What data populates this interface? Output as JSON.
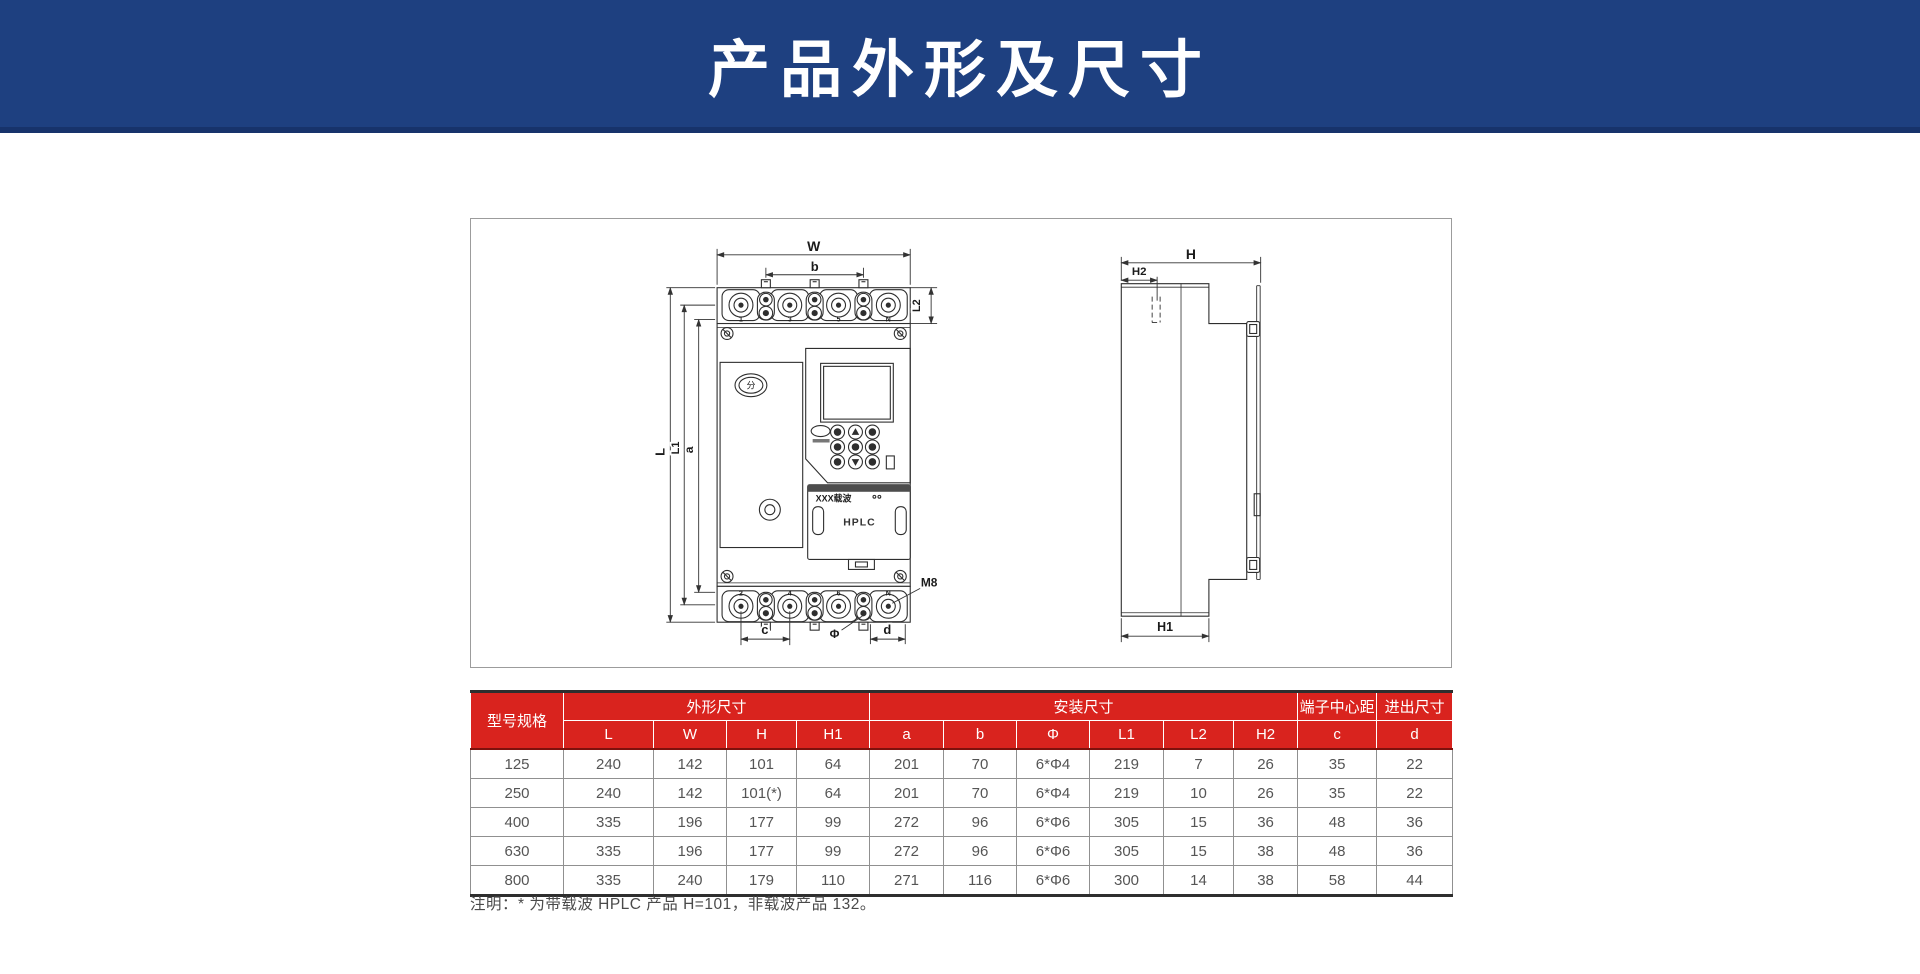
{
  "header": {
    "title": "产品外形及尺寸"
  },
  "colors": {
    "header_bg": "#1E4080",
    "header_strip": "#17336B",
    "table_red": "#D9231E"
  },
  "drawing": {
    "front": {
      "dim_W": "W",
      "dim_b": "b",
      "dim_L": "L",
      "dim_L1": "L1",
      "dim_a": "a",
      "dim_L2": "L2",
      "dim_c": "c",
      "dim_phi": "Φ",
      "dim_d": "d",
      "bolt_label": "M8",
      "top_terminal_labels": [
        "1",
        "3",
        "5",
        "N"
      ],
      "bottom_terminal_labels": [
        "2",
        "4",
        "6",
        "N"
      ],
      "logo_glyph": "分",
      "module_title": "XXX载波",
      "module_name": "HPLC"
    },
    "side": {
      "dim_H": "H",
      "dim_H2": "H2",
      "dim_H1": "H1"
    }
  },
  "table": {
    "header": {
      "model": "型号规格",
      "outline_group": "外形尺寸",
      "install_group": "安装尺寸",
      "terminal_pitch": "端子中心距",
      "inout": "进出尺寸",
      "sub": [
        "L",
        "W",
        "H",
        "H1",
        "a",
        "b",
        "Φ",
        "L1",
        "L2",
        "H2",
        "c",
        "d"
      ]
    },
    "rows": [
      {
        "model": "125",
        "values": [
          "240",
          "142",
          "101",
          "64",
          "201",
          "70",
          "6*Φ4",
          "219",
          "7",
          "26",
          "35",
          "22"
        ]
      },
      {
        "model": "250",
        "values": [
          "240",
          "142",
          "101(*)",
          "64",
          "201",
          "70",
          "6*Φ4",
          "219",
          "10",
          "26",
          "35",
          "22"
        ]
      },
      {
        "model": "400",
        "values": [
          "335",
          "196",
          "177",
          "99",
          "272",
          "96",
          "6*Φ6",
          "305",
          "15",
          "36",
          "48",
          "36"
        ]
      },
      {
        "model": "630",
        "values": [
          "335",
          "196",
          "177",
          "99",
          "272",
          "96",
          "6*Φ6",
          "305",
          "15",
          "38",
          "48",
          "36"
        ]
      },
      {
        "model": "800",
        "values": [
          "335",
          "240",
          "179",
          "110",
          "271",
          "116",
          "6*Φ6",
          "300",
          "14",
          "38",
          "58",
          "44"
        ]
      }
    ]
  },
  "note": "注明：* 为带载波 HPLC 产品 H=101，非载波产品 132。"
}
